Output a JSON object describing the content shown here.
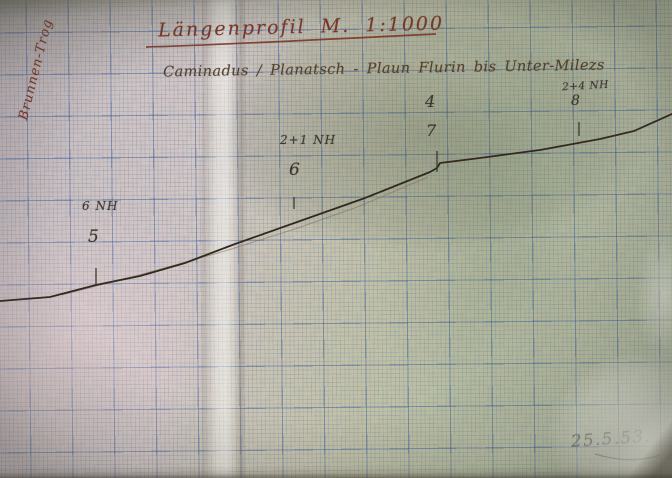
{
  "document": {
    "title": "Längenprofil  M. 1:1000",
    "subtitle": "Caminadus / Planatsch - Plaun Flurin bis Unter-Milezs",
    "side_label": "Brunnen-Trog",
    "date": "25.5.53."
  },
  "colors": {
    "ink_red": "#7d3526",
    "ink_brown": "#53402a",
    "pencil_dark": "#3c372e",
    "line_color": "#32291f",
    "construction_color": "#7a6a52",
    "date_color": "#474f47",
    "grid_major": "#345ca0",
    "grid_minor": "#5a8caa",
    "paper_pink": "#d5c6c4",
    "paper_green": "#bcbea1"
  },
  "chart_data": {
    "type": "line",
    "title": "Längenprofil M. 1:1000",
    "subtitle": "Caminadus / Planatsch - Plaun Flurin bis Unter-Milezs",
    "xlabel": "",
    "ylabel": "",
    "axes_visible": false,
    "grid": "millimeter graph paper, major squares ~42px, 10 minor divisions",
    "profile_points_px": [
      [
        0,
        301
      ],
      [
        50,
        297
      ],
      [
        96,
        285
      ],
      [
        140,
        276
      ],
      [
        185,
        263
      ],
      [
        235,
        244
      ],
      [
        300,
        221
      ],
      [
        365,
        198
      ],
      [
        430,
        172
      ],
      [
        437,
        168
      ],
      [
        440,
        163
      ],
      [
        480,
        158
      ],
      [
        540,
        150
      ],
      [
        600,
        139
      ],
      [
        634,
        131
      ],
      [
        672,
        114
      ]
    ],
    "construction_line_px": [
      [
        62,
        295
      ],
      [
        150,
        272
      ],
      [
        225,
        251
      ],
      [
        295,
        229
      ],
      [
        360,
        206
      ],
      [
        428,
        177
      ]
    ],
    "stations": [
      {
        "label_top": "6 NH",
        "label_num": "5",
        "x_px": 96,
        "tick_y1": 268,
        "tick_y2": 284
      },
      {
        "label_top": "2+1 NH",
        "label_num": "6",
        "x_px": 294,
        "tick_y1": 197,
        "tick_y2": 209
      },
      {
        "label_top": "4",
        "label_num": "7",
        "x_px": 437,
        "tick_y1": 151,
        "tick_y2": 172
      },
      {
        "label_top": "2+4 NH",
        "label_num": "8",
        "x_px": 579,
        "tick_y1": 122,
        "tick_y2": 136
      }
    ],
    "date_label": "25.5.53."
  }
}
